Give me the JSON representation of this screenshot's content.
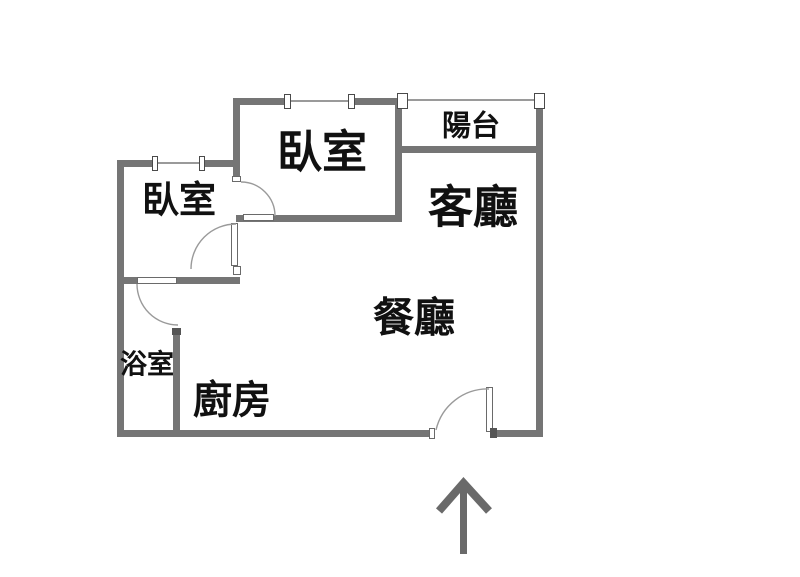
{
  "rooms": {
    "bedroom_main": {
      "label": "臥室"
    },
    "bedroom_second": {
      "label": "臥室"
    },
    "balcony": {
      "label": "陽台"
    },
    "living_room": {
      "label": "客廳"
    },
    "dining_room": {
      "label": "餐廳"
    },
    "bathroom": {
      "label": "浴室"
    },
    "kitchen": {
      "label": "廚房"
    }
  },
  "icons": {
    "entrance_arrow": "arrow-up",
    "doors": [
      "bedroom-main-door-swing",
      "bedroom-second-door-swing",
      "bathroom-door-swing",
      "entrance-door-swing"
    ],
    "windows": [
      "bedroom-main-window",
      "bedroom-second-window",
      "balcony-railing"
    ]
  },
  "colors": {
    "wall": "#757575",
    "window_and_arc_line": "#9a9a9a",
    "text": "#111111",
    "arrow": "#6a6a6a",
    "background": "#ffffff"
  }
}
